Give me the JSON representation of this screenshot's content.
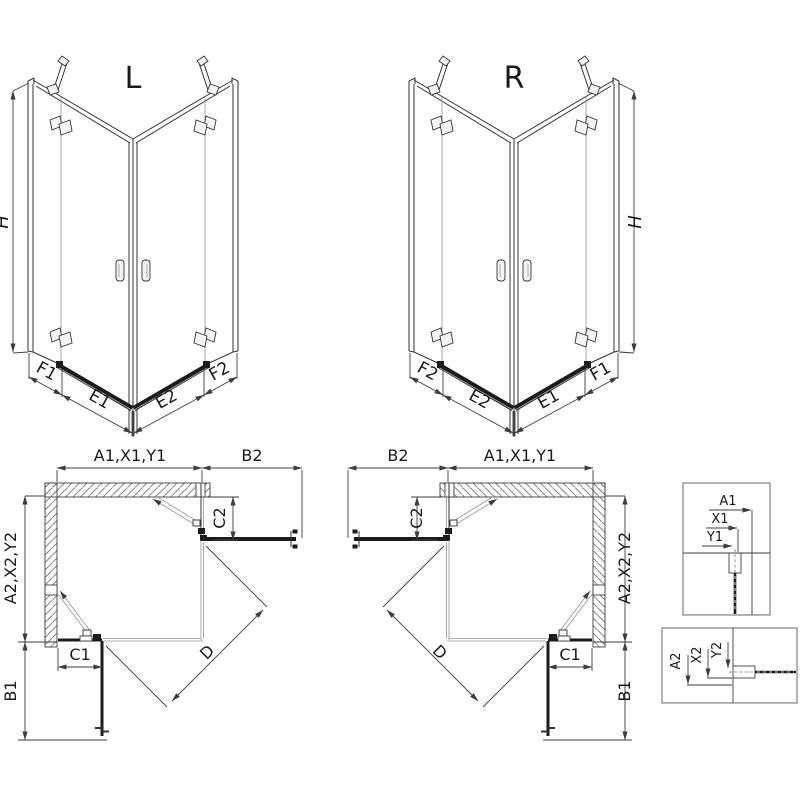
{
  "title": "Corner shower enclosure dimension diagram",
  "colors": {
    "background": "#ffffff",
    "line": "#333333",
    "dimension": "#3d3d3d",
    "dark_profile": "#1b1b1b",
    "glass_thin": "#949494",
    "wall_hatch": "#737373"
  },
  "views": {
    "iso_left": {
      "label": "L",
      "height_label": "H",
      "bottom_labels": [
        "F1",
        "E1",
        "E2",
        "F2"
      ]
    },
    "iso_right": {
      "label": "R",
      "height_label": "H",
      "bottom_labels": [
        "F2",
        "E2",
        "E1",
        "F1"
      ]
    },
    "plan_left": {
      "top_width_label": "A1,X1,Y1",
      "side_panel_label": "B2",
      "door_gap_label": "C2",
      "left_depth_label": "A2,X2,Y2",
      "bottom_fixed_label": "C1",
      "bottom_panel_label": "B1",
      "diagonal_label": "D"
    },
    "plan_right": {
      "side_panel_label": "B2",
      "top_width_label": "A1,X1,Y1",
      "door_gap_label": "C2",
      "right_depth_label": "A2,X2,Y2",
      "bottom_fixed_label": "C1",
      "bottom_panel_label": "B1",
      "diagonal_label": "D"
    },
    "detail_top": {
      "labels": [
        "A1",
        "X1",
        "Y1"
      ]
    },
    "detail_bottom": {
      "labels": [
        "A2",
        "X2",
        "Y2"
      ]
    }
  }
}
